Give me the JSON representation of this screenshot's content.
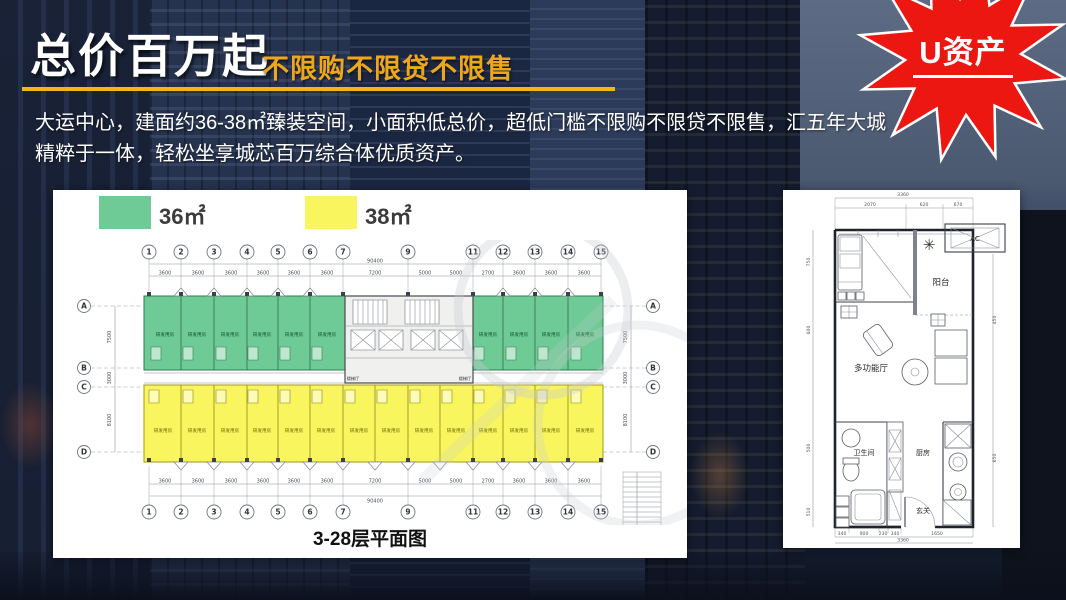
{
  "slide": {
    "title": "总价百万起",
    "subtitle": "不限购不限贷不限售",
    "description_line1": "大运中心，建面约36-38㎡臻装空间，小面积低总价，超低门槛不限购不限贷不限售，汇五年大城",
    "description_line2": "精粹于一体，轻松坐享城芯百万综合体优质资产。",
    "badge_label": "U资产",
    "colors": {
      "accent_gold": "#F5B517",
      "badge_red": "#ED1712",
      "unit_green": "#6FCB95",
      "unit_yellow": "#F8F55F"
    }
  },
  "legend": {
    "items": [
      {
        "label": "36㎡",
        "color": "#6FCB95"
      },
      {
        "label": "38㎡",
        "color": "#F8F55F"
      }
    ]
  },
  "floor_plan": {
    "caption": "3-28层平面图",
    "unit_label": "研发用房",
    "core_label": "楼梯厅",
    "total_top": "90400",
    "total_bottom": "90400",
    "axes_top": [
      "1",
      "2",
      "3",
      "4",
      "5",
      "6",
      "7",
      "9",
      "11",
      "12",
      "13",
      "14",
      "15"
    ],
    "axes_bottom": [
      "1",
      "2",
      "3",
      "4",
      "5",
      "6",
      "7",
      "9",
      "11",
      "12",
      "13",
      "14",
      "15"
    ],
    "axes_left": [
      "A",
      "B",
      "C",
      "D"
    ],
    "axes_right": [
      "A",
      "B",
      "C",
      "D"
    ],
    "dims_top": [
      "3600",
      "3600",
      "3600",
      "3600",
      "3600",
      "3600",
      "7200",
      "5000",
      "5000",
      "2700",
      "3600",
      "3600",
      "3600"
    ],
    "dims_bottom": [
      "3600",
      "3600",
      "3600",
      "3600",
      "3600",
      "3600",
      "7200",
      "5000",
      "5000",
      "2700",
      "3600",
      "3600",
      "3600"
    ],
    "dims_left": [
      "7500",
      "3000",
      "8100"
    ]
  },
  "unit_plan": {
    "rooms": {
      "balcony": "阳台",
      "hall": "多功能厅",
      "bath": "卫生间",
      "kitchen": "厨房",
      "entry": "玄关",
      "ac": "AC"
    },
    "dims_top_total": "3360",
    "dims_top": [
      "2070",
      "620",
      "670"
    ],
    "dims_bottom": [
      "340",
      "900",
      "230",
      "340",
      "1650"
    ],
    "dims_bottom_total": "3360",
    "dims_left": [
      "750",
      "600",
      "500",
      "510"
    ],
    "dims_right": [
      "450",
      "650"
    ]
  }
}
